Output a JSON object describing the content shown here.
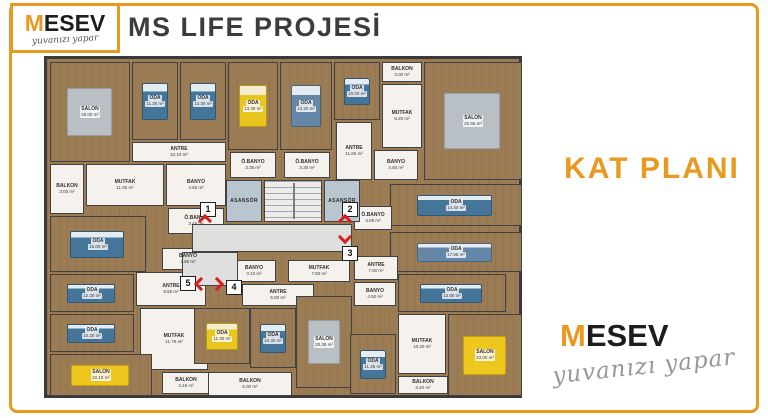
{
  "header": {
    "title": "MS LIFE PROJESİ"
  },
  "side_label": "KAT PLANI",
  "logo_top": {
    "m": "M",
    "rest": "ESEV",
    "tagline": "yuvanızı yapar"
  },
  "logo_bottom": {
    "m": "M",
    "rest": "ESEV",
    "tagline": "yuvanızı yapar"
  },
  "colors": {
    "accent": "#E8991F",
    "title_gray": "#3C3C3C",
    "wall": "#424242",
    "wood_floor": "#9C7C55",
    "white_room": "#F5F2ED",
    "marker_red": "#D81F1F"
  },
  "floor_plan": {
    "elevator_label": "ASANSÖR",
    "rooms": [
      {
        "name": "SALON",
        "area": "25.00 m²",
        "x": 14,
        "y": 6,
        "w": 80,
        "h": 100,
        "type": "wood",
        "furn": "rug"
      },
      {
        "name": "ODA",
        "area": "11.30 m²",
        "x": 96,
        "y": 6,
        "w": 46,
        "h": 78,
        "type": "wood",
        "furn": "bed-teal"
      },
      {
        "name": "ODA",
        "area": "13.30 m²",
        "x": 144,
        "y": 6,
        "w": 46,
        "h": 78,
        "type": "wood",
        "furn": "bed-teal"
      },
      {
        "name": "ODA",
        "area": "13.30 m²",
        "x": 192,
        "y": 6,
        "w": 50,
        "h": 88,
        "type": "wood",
        "furn": "bed-yellow"
      },
      {
        "name": "ODA",
        "area": "13.20 m²",
        "x": 244,
        "y": 6,
        "w": 52,
        "h": 88,
        "type": "wood",
        "furn": "bed-blue"
      },
      {
        "name": "ODA",
        "area": "10.00 m²",
        "x": 298,
        "y": 6,
        "w": 46,
        "h": 58,
        "type": "wood",
        "furn": "bed-teal"
      },
      {
        "name": "BALKON",
        "area": "3.00 m²",
        "x": 346,
        "y": 6,
        "w": 40,
        "h": 20,
        "type": "white"
      },
      {
        "name": "MUTFAK",
        "area": "8.20 m²",
        "x": 346,
        "y": 28,
        "w": 40,
        "h": 64,
        "type": "white"
      },
      {
        "name": "SALON",
        "area": "20.65 m²",
        "x": 388,
        "y": 6,
        "w": 98,
        "h": 118,
        "type": "wood",
        "furn": "rug"
      },
      {
        "name": "ANTRE",
        "area": "10.10 m²",
        "x": 96,
        "y": 86,
        "w": 94,
        "h": 20,
        "type": "white"
      },
      {
        "name": "ANTRE",
        "area": "11.65 m²",
        "x": 300,
        "y": 66,
        "w": 36,
        "h": 58,
        "type": "white"
      },
      {
        "name": "BALKON",
        "area": "3.00 m²",
        "x": 14,
        "y": 108,
        "w": 34,
        "h": 50,
        "type": "white"
      },
      {
        "name": "MUTFAK",
        "area": "11.00 m²",
        "x": 50,
        "y": 108,
        "w": 78,
        "h": 42,
        "type": "white"
      },
      {
        "name": "BANYO",
        "area": "4.65 m²",
        "x": 130,
        "y": 108,
        "w": 60,
        "h": 42,
        "type": "white"
      },
      {
        "name": "Ö.BANYO",
        "area": "3.35 m²",
        "x": 194,
        "y": 96,
        "w": 46,
        "h": 26,
        "type": "white"
      },
      {
        "name": "Ö.BANYO",
        "area": "3.30 m²",
        "x": 248,
        "y": 96,
        "w": 46,
        "h": 26,
        "type": "white"
      },
      {
        "name": "BANYO",
        "area": "4.50 m²",
        "x": 338,
        "y": 94,
        "w": 44,
        "h": 30,
        "type": "white"
      },
      {
        "name": "ODA",
        "area": "16.00 m²",
        "x": 14,
        "y": 160,
        "w": 96,
        "h": 56,
        "type": "wood",
        "furn": "bed-teal"
      },
      {
        "name": "Ö.BANYO",
        "area": "3.45 m²",
        "x": 132,
        "y": 152,
        "w": 56,
        "h": 26,
        "type": "white"
      },
      {
        "name": "BANYO",
        "area": "4.85 m²",
        "x": 126,
        "y": 192,
        "w": 52,
        "h": 22,
        "type": "white"
      },
      {
        "name": "ODA",
        "area": "14.40 m²",
        "x": 354,
        "y": 128,
        "w": 132,
        "h": 42,
        "type": "wood",
        "furn": "bed-teal"
      },
      {
        "name": "Ö.BANYO",
        "area": "3.85 m²",
        "x": 318,
        "y": 150,
        "w": 38,
        "h": 24,
        "type": "white"
      },
      {
        "name": "ODA",
        "area": "17.55 m²",
        "x": 354,
        "y": 176,
        "w": 132,
        "h": 40,
        "type": "wood",
        "furn": "bed-blue"
      },
      {
        "name": "ODA",
        "area": "12.30 m²",
        "x": 14,
        "y": 218,
        "w": 84,
        "h": 38,
        "type": "wood",
        "furn": "bed-teal"
      },
      {
        "name": "ODA",
        "area": "10.20 m²",
        "x": 14,
        "y": 258,
        "w": 84,
        "h": 38,
        "type": "wood",
        "furn": "bed-teal"
      },
      {
        "name": "ANTRE",
        "area": "8.55 m²",
        "x": 100,
        "y": 216,
        "w": 70,
        "h": 34,
        "type": "white"
      },
      {
        "name": "MUTFAK",
        "area": "11.75 m²",
        "x": 104,
        "y": 252,
        "w": 68,
        "h": 62,
        "type": "white"
      },
      {
        "name": "SALON",
        "area": "20.10 m²",
        "x": 14,
        "y": 298,
        "w": 102,
        "h": 42,
        "type": "wood",
        "furn": "sofa-yellow"
      },
      {
        "name": "BALKON",
        "area": "3.15 m²",
        "x": 126,
        "y": 316,
        "w": 48,
        "h": 22,
        "type": "white"
      },
      {
        "name": "BANYO",
        "area": "3.10 m²",
        "x": 196,
        "y": 204,
        "w": 44,
        "h": 22,
        "type": "white"
      },
      {
        "name": "MUTFAK",
        "area": "7.50 m²",
        "x": 252,
        "y": 204,
        "w": 62,
        "h": 22,
        "type": "white"
      },
      {
        "name": "ANTRE",
        "area": "5.00 m²",
        "x": 206,
        "y": 228,
        "w": 72,
        "h": 22,
        "type": "white"
      },
      {
        "name": "ODA",
        "area": "11.30 m²",
        "x": 158,
        "y": 252,
        "w": 56,
        "h": 56,
        "type": "wood",
        "furn": "bed-yellow"
      },
      {
        "name": "ODA",
        "area": "10.30 m²",
        "x": 214,
        "y": 252,
        "w": 46,
        "h": 60,
        "type": "wood",
        "furn": "bed-teal"
      },
      {
        "name": "SALON",
        "area": "20.35 m²",
        "x": 260,
        "y": 240,
        "w": 56,
        "h": 92,
        "type": "wood",
        "furn": "rug"
      },
      {
        "name": "BALKON",
        "area": "6.00 m²",
        "x": 172,
        "y": 316,
        "w": 84,
        "h": 24,
        "type": "white"
      },
      {
        "name": "ANTRE",
        "area": "7.50 m²",
        "x": 318,
        "y": 200,
        "w": 44,
        "h": 24,
        "type": "white"
      },
      {
        "name": "BANYO",
        "area": "4.50 m²",
        "x": 318,
        "y": 226,
        "w": 42,
        "h": 24,
        "type": "white"
      },
      {
        "name": "ODA",
        "area": "13.80 m²",
        "x": 362,
        "y": 218,
        "w": 108,
        "h": 38,
        "type": "wood",
        "furn": "bed-teal"
      },
      {
        "name": "ODA",
        "area": "11.35 m²",
        "x": 314,
        "y": 278,
        "w": 46,
        "h": 60,
        "type": "wood",
        "furn": "bed-teal"
      },
      {
        "name": "MUTFAK",
        "area": "10.20 m²",
        "x": 362,
        "y": 258,
        "w": 48,
        "h": 60,
        "type": "white"
      },
      {
        "name": "SALON",
        "area": "23.00 m²",
        "x": 412,
        "y": 258,
        "w": 74,
        "h": 82,
        "type": "wood",
        "furn": "sofa-yellow"
      },
      {
        "name": "BALKON",
        "area": "3.40 m²",
        "x": 362,
        "y": 320,
        "w": 50,
        "h": 18,
        "type": "white"
      }
    ],
    "halls": [
      {
        "x": 156,
        "y": 168,
        "w": 160,
        "h": 28
      },
      {
        "x": 146,
        "y": 196,
        "w": 56,
        "h": 34
      }
    ],
    "elevators": [
      {
        "x": 190,
        "y": 124,
        "w": 36,
        "h": 42
      },
      {
        "x": 288,
        "y": 124,
        "w": 36,
        "h": 42
      }
    ],
    "stairs": {
      "x": 228,
      "y": 124,
      "w": 58,
      "h": 42
    },
    "unit_markers": [
      {
        "number": "1",
        "x": 164,
        "y": 146
      },
      {
        "number": "2",
        "x": 306,
        "y": 146
      },
      {
        "number": "3",
        "x": 306,
        "y": 190
      },
      {
        "number": "4",
        "x": 190,
        "y": 224
      },
      {
        "number": "5",
        "x": 144,
        "y": 220
      }
    ],
    "entry_chevrons": [
      {
        "dir": "up",
        "x": 164,
        "y": 160
      },
      {
        "dir": "up",
        "x": 304,
        "y": 160
      },
      {
        "dir": "down",
        "x": 304,
        "y": 176
      },
      {
        "dir": "left",
        "x": 160,
        "y": 223
      },
      {
        "dir": "right",
        "x": 176,
        "y": 223
      }
    ]
  }
}
